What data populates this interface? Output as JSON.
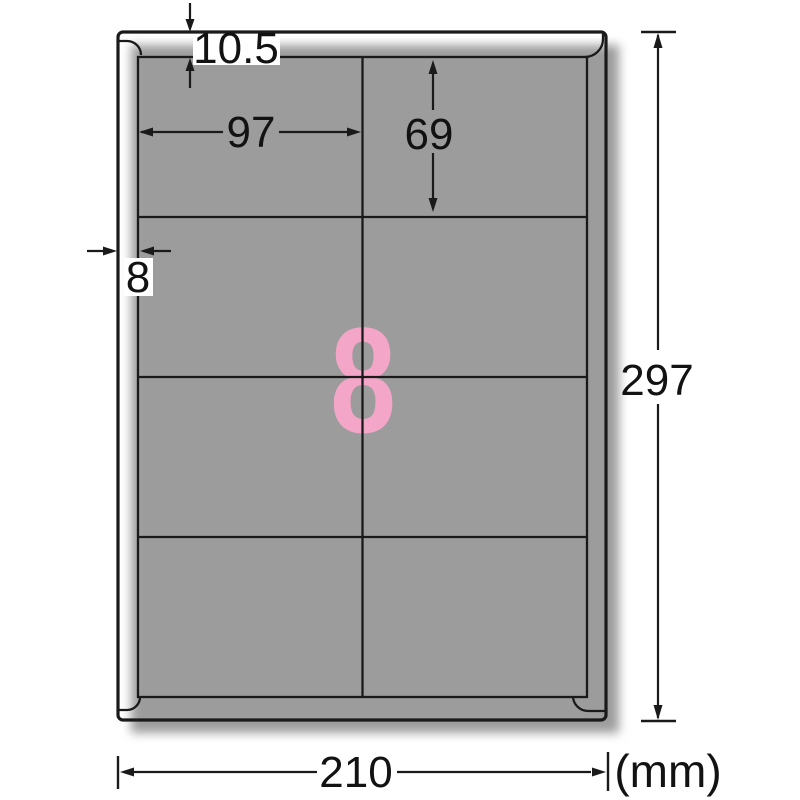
{
  "sheet": {
    "labels_per_sheet": "8",
    "grid_rows": 4,
    "grid_columns": 2
  },
  "dimensions_mm": {
    "top_margin": "10.5",
    "label_width": "97",
    "label_height": "69",
    "side_margin": "8",
    "sheet_height": "297",
    "sheet_width": "210",
    "unit": "(mm)"
  },
  "colors": {
    "label_count_pink": "#f4a6c8",
    "line_black": "#1a1a1a",
    "shadow_gray": "#9c9c9c"
  }
}
